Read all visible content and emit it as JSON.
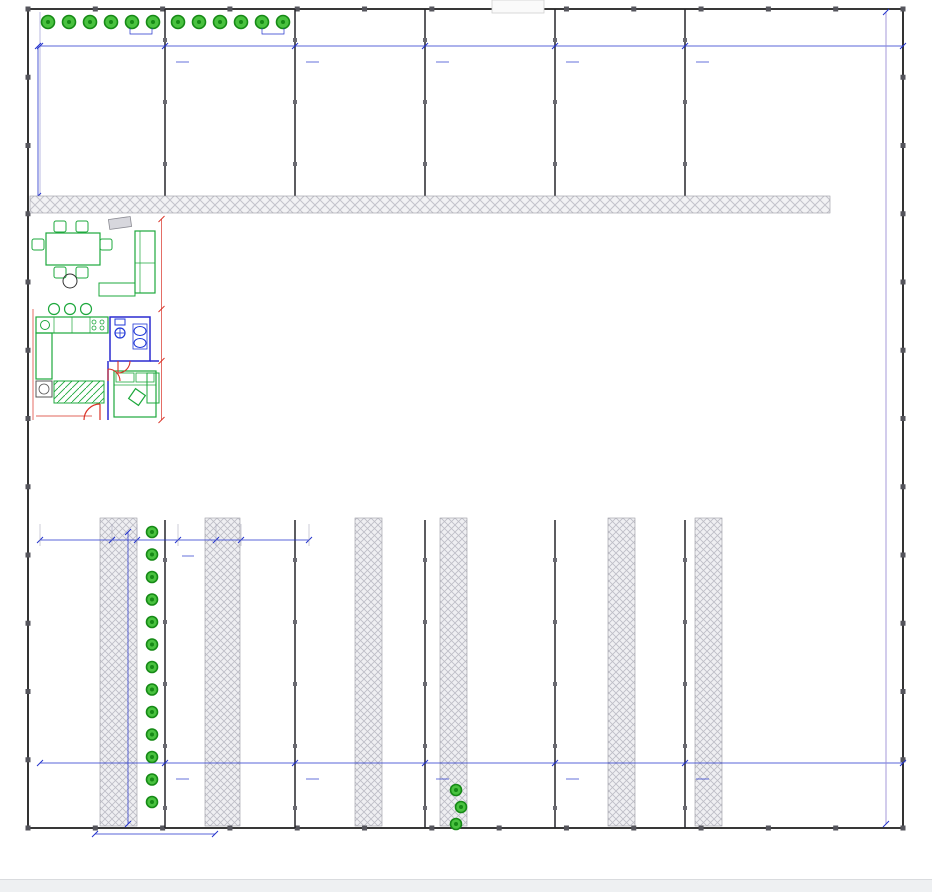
{
  "dims": {
    "top": [
      "6600",
      "6350",
      "6350",
      "6350",
      "6350",
      "10700"
    ],
    "bottom": [
      "6600",
      "6350",
      "6350",
      "6350",
      "6350",
      "10700"
    ],
    "mid": [
      "3500",
      "1200",
      "1980",
      "1850",
      "1200",
      "3300"
    ],
    "gap": "50",
    "left_height": "9375",
    "right_height": "39950",
    "walkway_length": "15575",
    "gate_width": "3380",
    "stair_width": "600",
    "porch_depth": "1300",
    "ramp_offset": "300",
    "porch_level": "750",
    "tree_spacing": [
      "1000",
      "500"
    ],
    "detail": [
      "4910",
      "3200",
      "1710",
      "50",
      "100",
      "3700"
    ]
  },
  "units": {
    "numbers": [
      "1",
      "2",
      "3",
      "4",
      "5",
      "6"
    ],
    "rooms": {
      "living": "Вітальня",
      "kitchen": "Кухня",
      "bedroom": "Спальня",
      "wc": "Санвузол"
    },
    "ac_label": "КОНДИЦІОНЕР",
    "porch_note_lines": [
      "рівень",
      "чистої",
      "ступені"
    ]
  },
  "colors": {
    "dimension_blue": "#2333cc",
    "wall_purple": "#8a1fb4",
    "wall_navy": "#2a2ad0",
    "furniture_green": "#1da83c",
    "fixture_blue": "#2038d8",
    "annotation_red": "#d93025",
    "car_blue": "#2b7fd8",
    "tree_green": "#2fae2b",
    "fence_black": "#1c1c1c",
    "hatch_gray": "#bcbcc4",
    "detail_magenta": "#cc22cc"
  }
}
